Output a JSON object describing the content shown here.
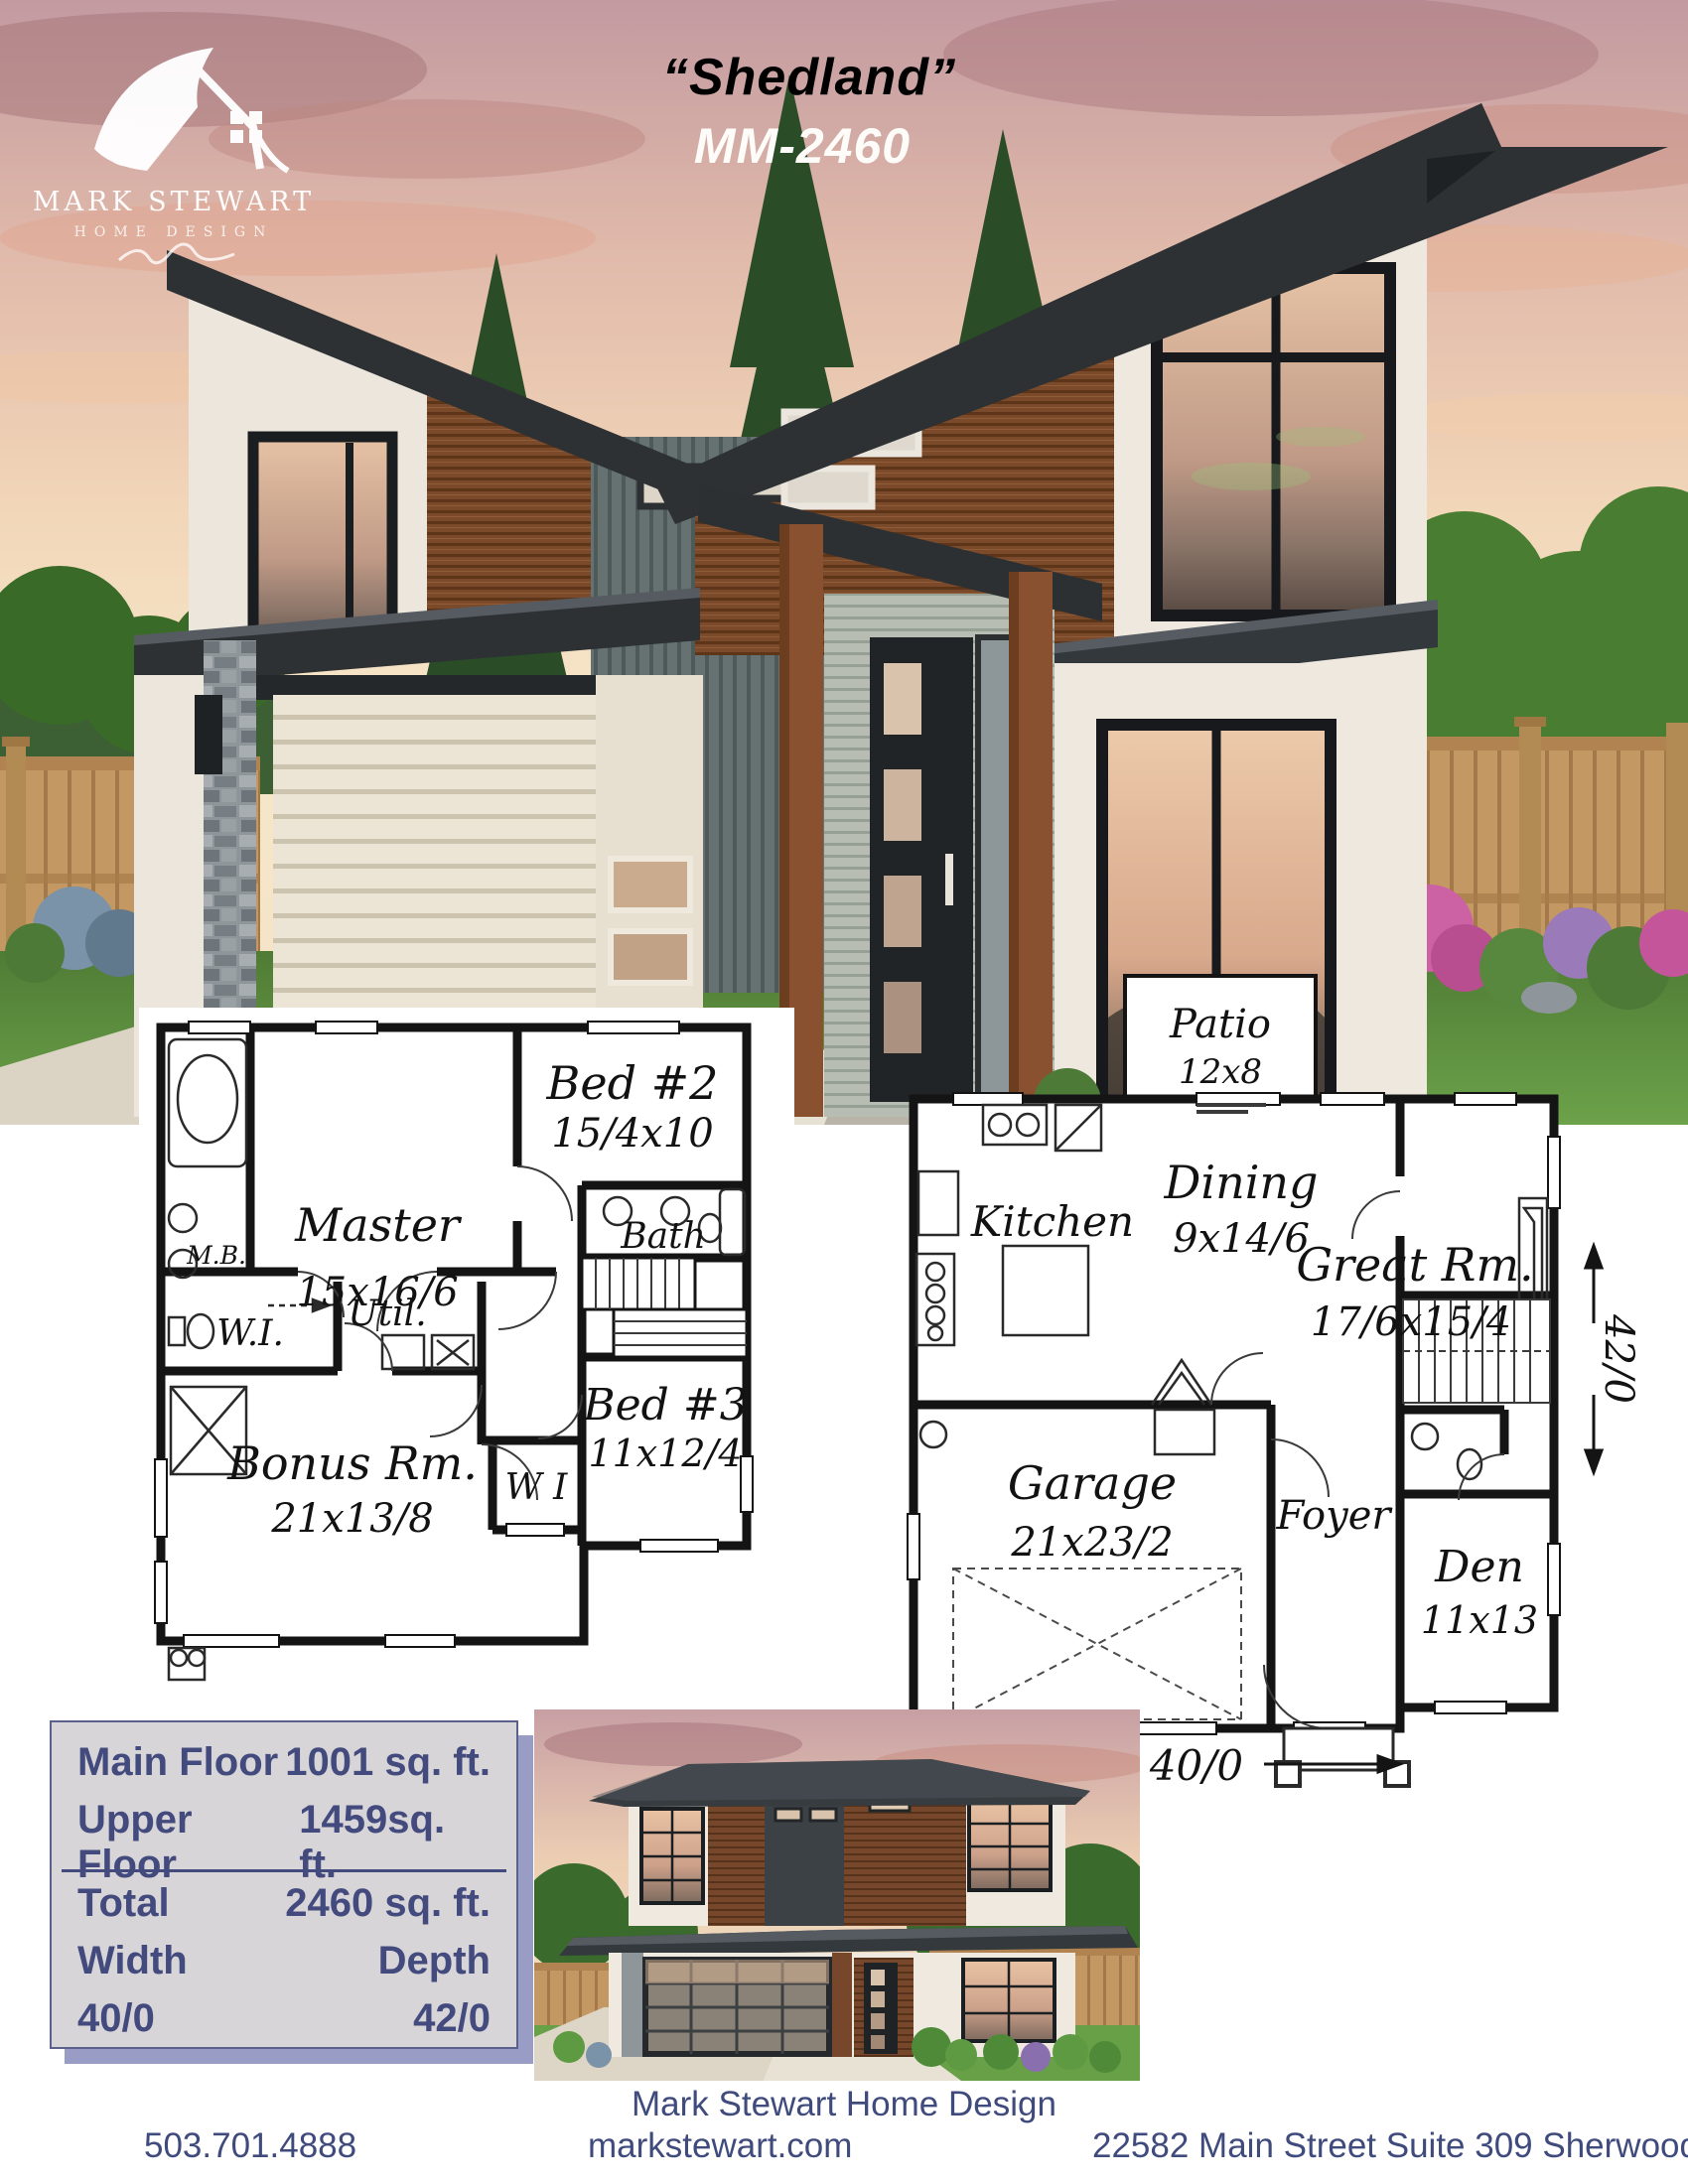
{
  "header": {
    "plan_name": "“Shedland”",
    "plan_code": "MM-2460"
  },
  "logo": {
    "name": "MARK STEWART",
    "subtitle": "HOME DESIGN"
  },
  "upper_plan": {
    "master_name": "Master",
    "master_dim": "15x16/6",
    "mb_label": "M.B.",
    "bed2_name": "Bed #2",
    "bed2_dim": "15/4x10",
    "bath_label": "Bath",
    "util_label": "Util.",
    "wi_label": "W.I.",
    "bonus_name": "Bonus Rm.",
    "bonus_dim": "21x13/8",
    "wi2_label": "W I",
    "bed3_name": "Bed #3",
    "bed3_dim": "11x12/4"
  },
  "main_plan": {
    "patio_name": "Patio",
    "patio_dim": "12x8",
    "kitchen_label": "Kitchen",
    "dining_name": "Dining",
    "dining_dim": "9x14/6",
    "great_name": "Great Rm.",
    "great_dim": "17/6x15/4",
    "garage_name": "Garage",
    "garage_dim": "21x23/2",
    "foyer_label": "Foyer",
    "den_name": "Den",
    "den_dim": "11x13",
    "width_dim": "40/0",
    "depth_dim": "42/0"
  },
  "stats": {
    "rows": [
      {
        "label": "Main Floor",
        "value": "1001 sq. ft."
      },
      {
        "label": "Upper Floor",
        "value": "1459sq. ft."
      },
      {
        "label": "Total",
        "value": "2460 sq. ft."
      },
      {
        "label": "Width",
        "value": "Depth"
      },
      {
        "label": "40/0",
        "value": "42/0"
      }
    ]
  },
  "footer": {
    "company": "Mark Stewart Home Design",
    "phone": "503.701.4888",
    "website": "markstewart.com",
    "address": "22582 Main Street Suite 309 Sherwood, OR 97140"
  }
}
